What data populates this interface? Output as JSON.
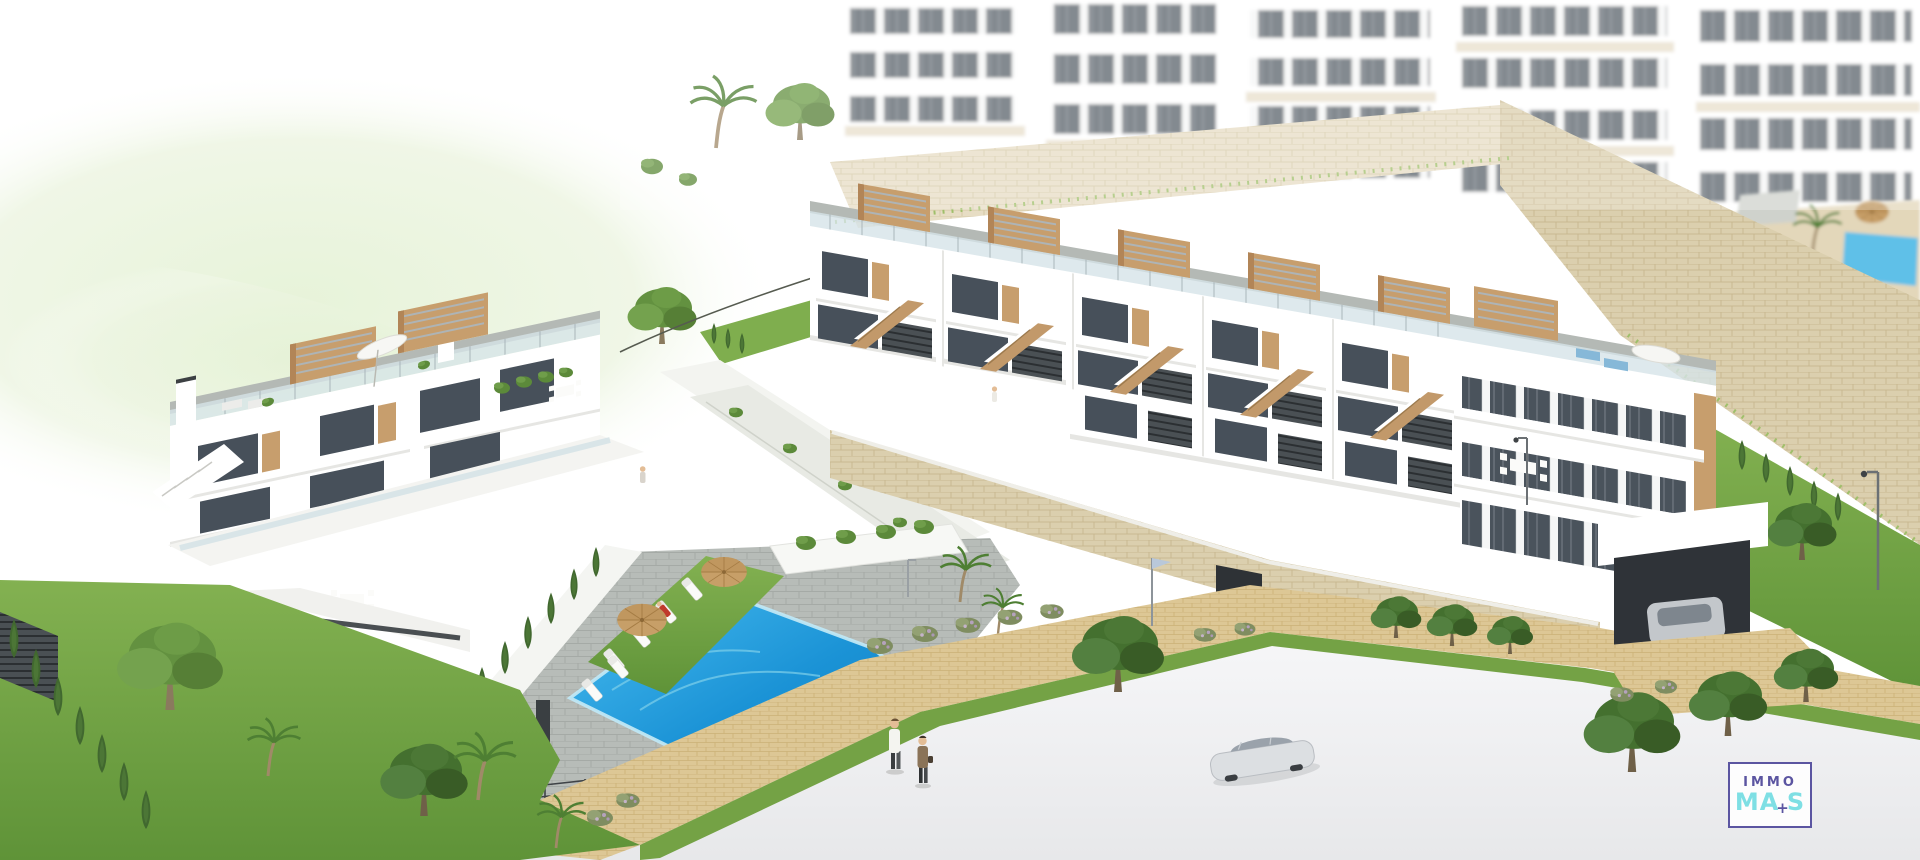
{
  "image": {
    "type": "architectural-3d-render",
    "subject": "Modern white townhouse development on a hillside with communal swimming pool, rooftop terraces with wooden pergolas, stone retaining walls, gardens, road and cars",
    "background": "#ffffff"
  },
  "palette": {
    "canvas": "#ffffff",
    "building_white": "#ffffff",
    "window_glass": "#47505a",
    "wood_tan": "#c79e6d",
    "terrace_grey": "#b4b9b5",
    "balustrade_glass": "#d6e4e8",
    "stone_beige": "#dbcfae",
    "grass_green": "#74a245",
    "pool_blue_deep": "#0e7cc0",
    "pool_blue_light": "#49bdf0",
    "path_tan": "#ddc795",
    "road_grey": "#eeeef0",
    "hill_green": "#e3f1d3",
    "logo_purple": "#5b55a1",
    "logo_cyan": "#7edfe4"
  },
  "logo": {
    "line1": "IMMO",
    "line2_a": "MA",
    "plus": "+",
    "line2_b": "S"
  },
  "scene": {
    "elements": [
      "hazy-apartment-blocks-background",
      "background-courtyard-pool",
      "stone-retaining-walls",
      "right-townhouse-row-with-pergolas-and-stairs",
      "left-townhouse-block-with-roof-terraces",
      "communal-swimming-pool",
      "sun-loungers-and-parasols",
      "lawn-and-cypress-hedges",
      "trees-and-palms",
      "tan-paved-walkway",
      "road",
      "silver-car",
      "carport-car",
      "walking-people",
      "street-lamps",
      "flag-pole",
      "immomas-logo"
    ]
  }
}
